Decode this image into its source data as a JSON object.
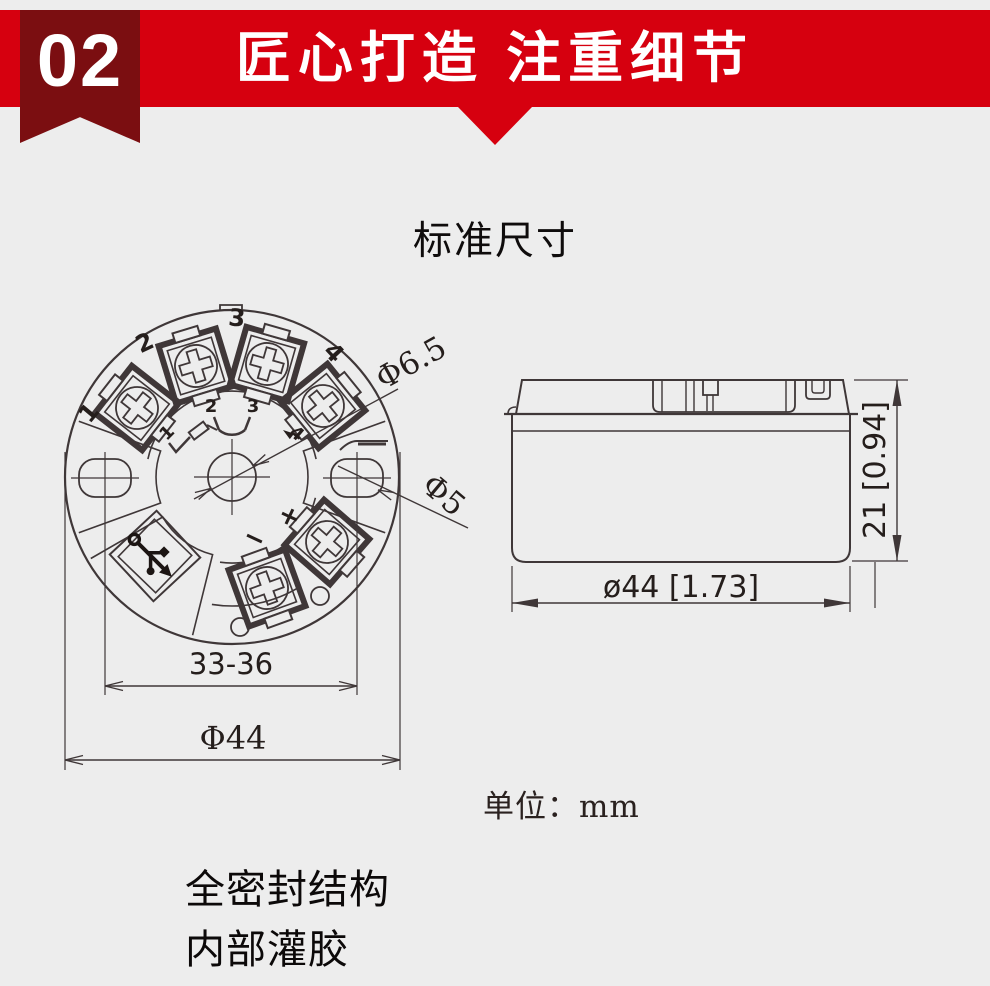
{
  "banner": {
    "number": "02",
    "title": "匠心打造 注重细节",
    "red": "#d6000f",
    "dark_red": "#7b0e11"
  },
  "section": {
    "title": "标准尺寸",
    "unit_label": "单位：mm",
    "features": [
      "全密封结构",
      "内部灌胶"
    ]
  },
  "diagram": {
    "line_color": "#3f3738",
    "top_view": {
      "terminal_numbers": [
        "1",
        "2",
        "3",
        "4"
      ],
      "schematic_numbers": [
        "1",
        "2",
        "3",
        "4"
      ],
      "plus": "+",
      "minus": "−",
      "dim_center_hole": "Φ6.5",
      "dim_side_hole": "Φ5",
      "dim_span": "33-36",
      "dim_diameter": "Φ44"
    },
    "side_view": {
      "dim_width": "ø44 [1.73]",
      "dim_height": "21 [0.94]"
    }
  }
}
